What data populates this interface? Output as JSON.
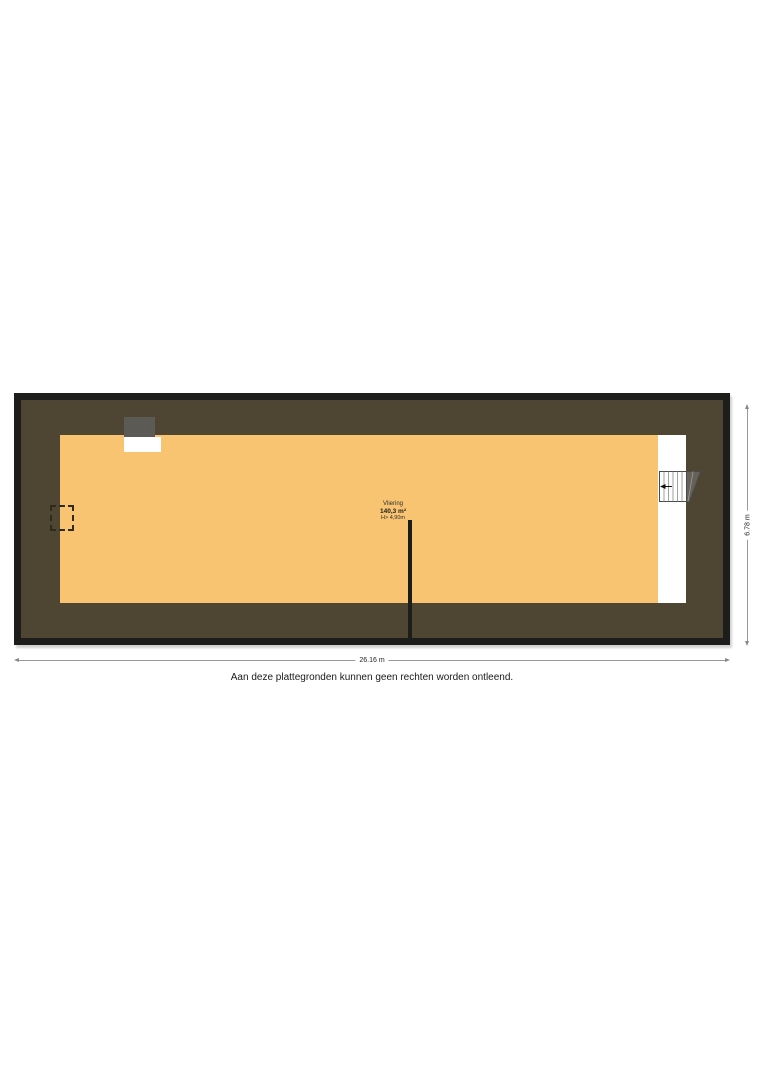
{
  "floorplan": {
    "room": {
      "name": "Vliering",
      "area": "140,3 m²",
      "height_clearance": "H> 4,90m"
    },
    "dimensions": {
      "width_label": "26.16 m",
      "height_label": "6.78 m"
    },
    "disclaimer": "Aan deze plattegronden kunnen geen rechten worden ontleend.",
    "colors": {
      "floor_fill": "#f8c471",
      "roof_band": "#4e4633",
      "outer_wall": "#1d1d1b",
      "dormer_roof": "#5c5a55",
      "stair_well": "#ffffff",
      "dimension_line": "#999999"
    },
    "icons": {
      "stairs": "stairs-icon",
      "stair_arrow": "stair-direction-arrow-icon",
      "hatch": "dashed-hatch-icon",
      "dormer": "dormer-window"
    }
  }
}
